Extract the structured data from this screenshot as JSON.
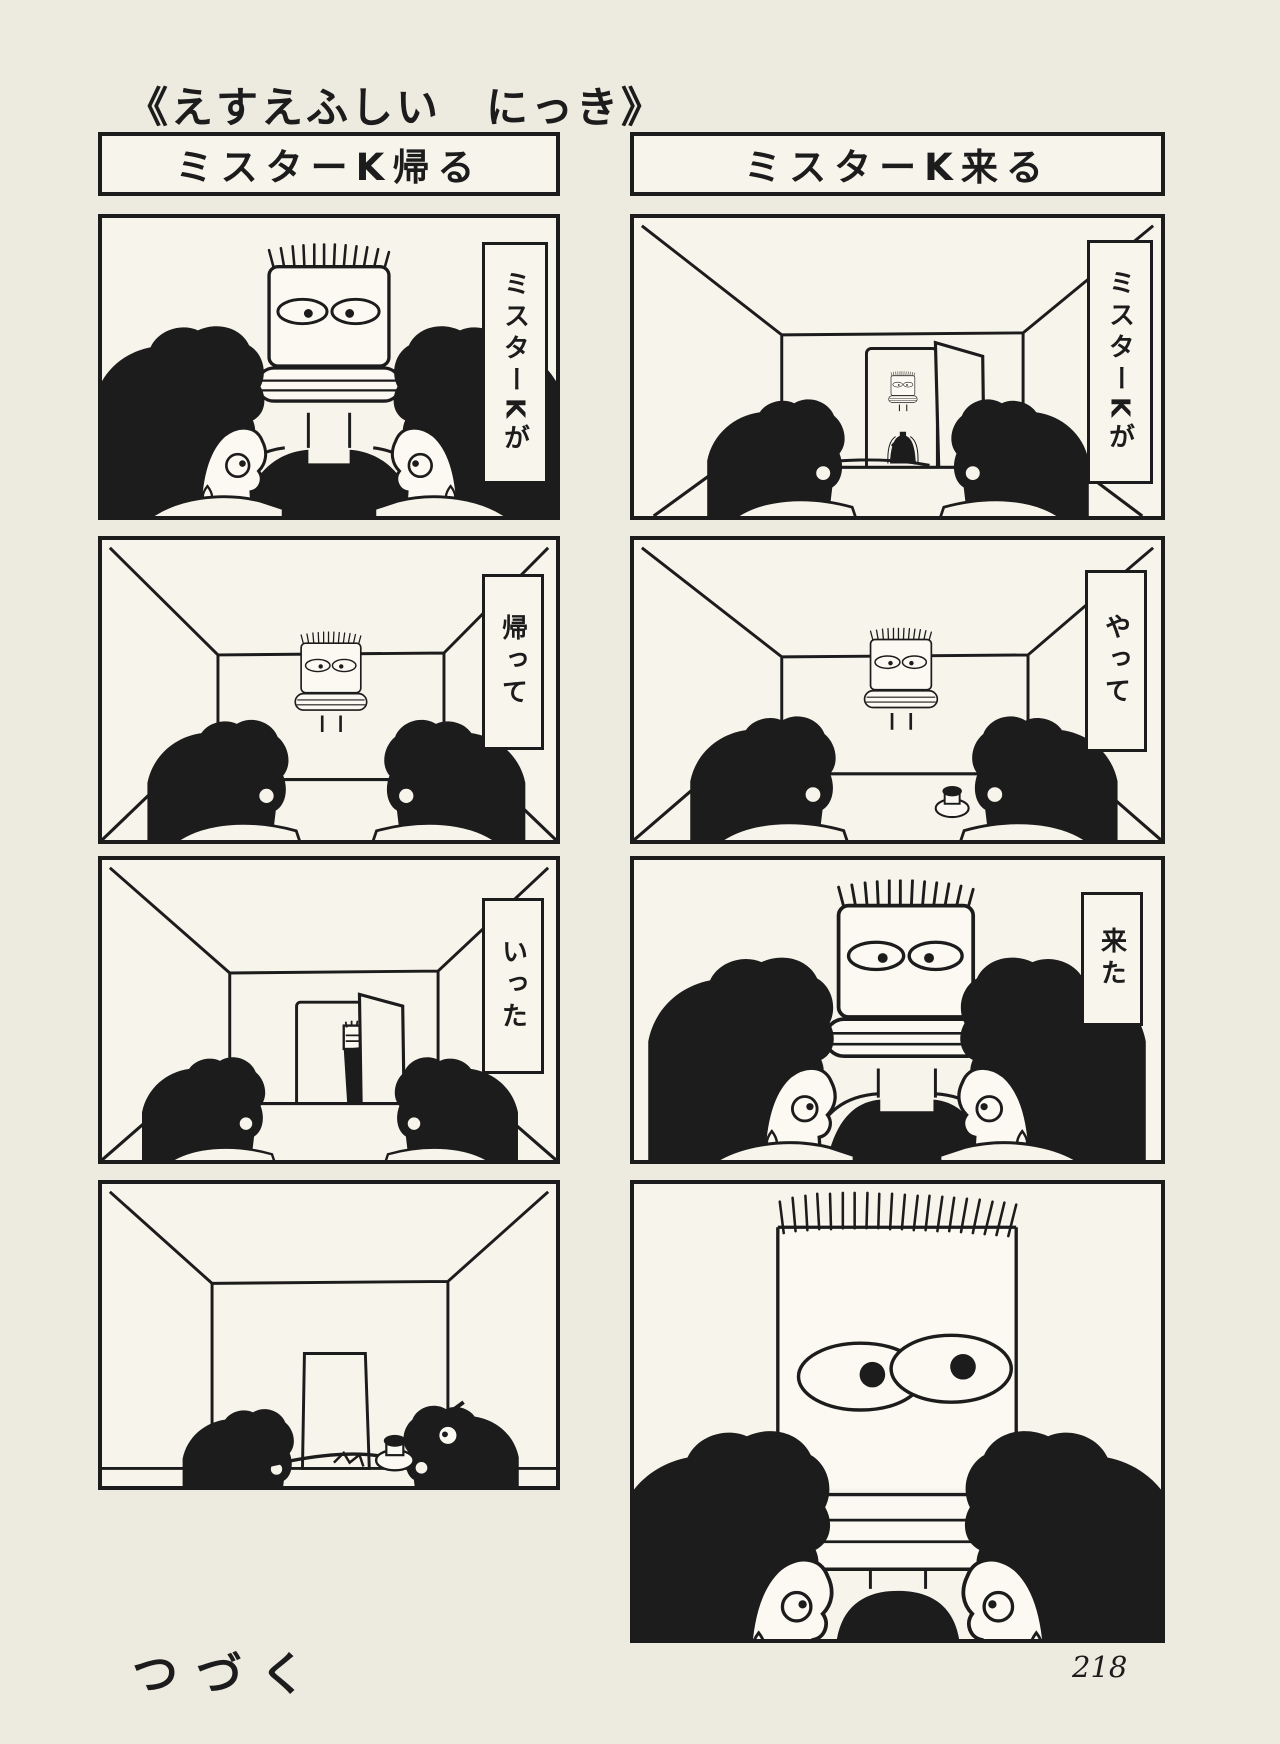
{
  "page": {
    "title": "《えすえふしい　にっき》",
    "footer_note": "つづく",
    "page_number": "218"
  },
  "colors": {
    "paper": "#edeadf",
    "panel_background": "#f7f4eb",
    "ink": "#1c1c1c"
  },
  "strips": {
    "left": {
      "header": "ミスターK帰る",
      "panels": [
        {
          "scene": "mister-k-closeup-between-boys",
          "bubble": "ミスターKが"
        },
        {
          "scene": "mister-k-standing-behind-table",
          "bubble": "帰って"
        },
        {
          "scene": "mister-k-leaving-through-door",
          "bubble": "いった"
        },
        {
          "scene": "boys-alone-working-at-table",
          "bubble": ""
        }
      ]
    },
    "right": {
      "header": "ミスターK来る",
      "panels": [
        {
          "scene": "mister-k-appears-in-doorway",
          "bubble": "ミスターKが"
        },
        {
          "scene": "mister-k-standing-behind-table",
          "bubble": "やって"
        },
        {
          "scene": "mister-k-closeup-between-boys",
          "bubble": "来た"
        },
        {
          "scene": "mister-k-giant-face-closeup",
          "bubble": ""
        }
      ]
    }
  }
}
